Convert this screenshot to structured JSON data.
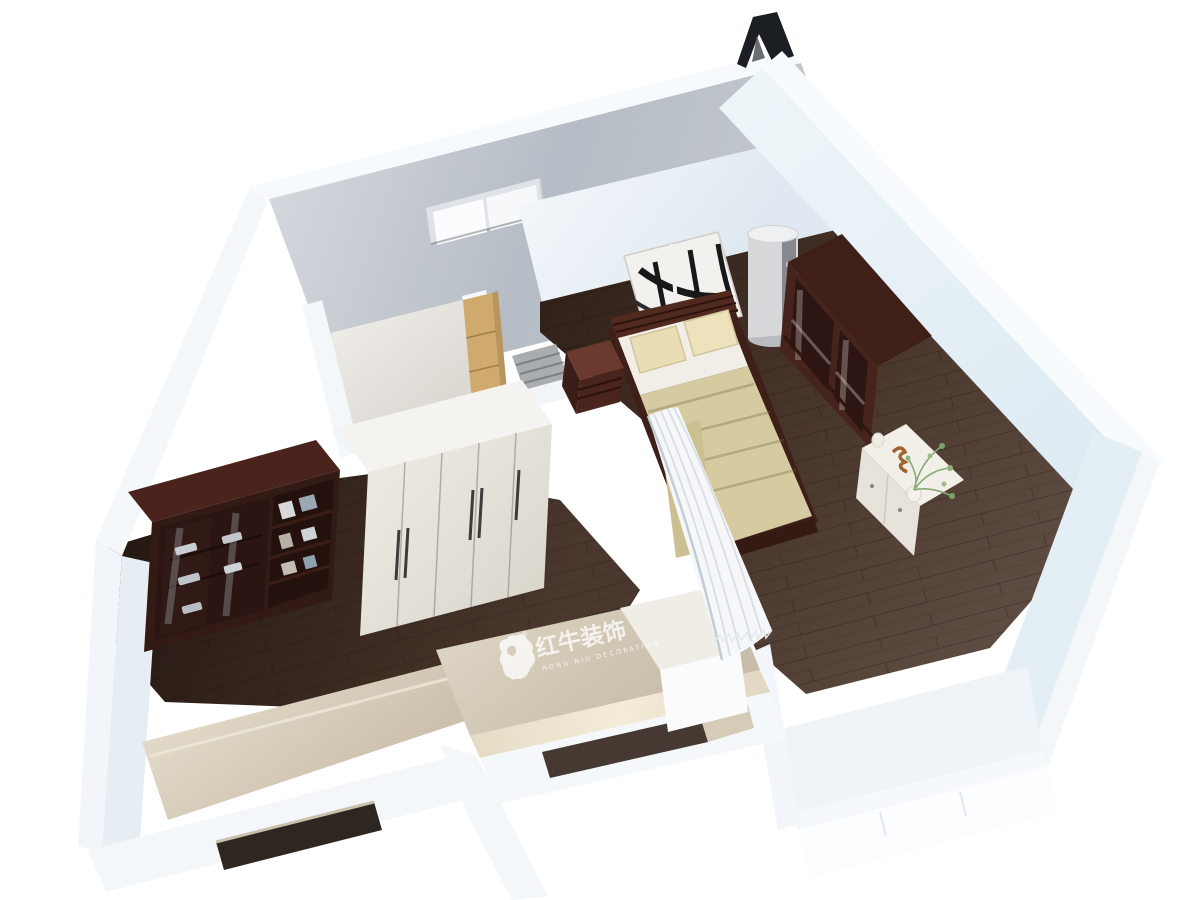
{
  "scene": {
    "type": "3d-floorplan-render",
    "description": "Bird's-eye 3D dollhouse render of a small apartment: bedroom with dark-wood floor and mahogany furniture, study room with bookcase and white wardrobe, entry hall, two bay/balcony niches, white walls on a white background",
    "background_color": "#ffffff"
  },
  "watermark": {
    "logo_icon": "bull-logo",
    "registered_mark": "®",
    "title": "红牛装饰",
    "subtitle": "HONG NIU DECORATION",
    "color": "#ffffff"
  },
  "palette": {
    "wall_white": "#f5f9fc",
    "wall_face_light": "#e9f1f7",
    "wall_face_shadow": "#dce7f0",
    "exterior_wall_gray": "#bcc2ca",
    "floor_dark_wood": "#362519",
    "floor_mid_wood": "#4e3b31",
    "floor_light_wood": "#5f4e44",
    "mahogany_dark": "#3f2019",
    "mahogany_mid": "#5a2d24",
    "bedding_sheet_white": "#f0eee6",
    "blanket_beige": "#d6caa0",
    "pillow_beige": "#e9ddb6",
    "curtain_white": "#f5f7f9",
    "balcony_beige": "#d9d0bf",
    "glow_warm": "#f0e7d3",
    "closet_wood_tan": "#d0a96e",
    "ac_body_gray": "#d6d8d9",
    "ac_slot_dark": "#85898c",
    "white_furniture": "#e9e6de",
    "plant_green": "#7da468",
    "ornament_black": "#1b1e23",
    "window_slot_dark": "#3a2f28"
  },
  "architecture": {
    "rear_window": {
      "name": "rear-wall-window",
      "panes": 2
    },
    "entry_door": {
      "name": "entry-door-opening",
      "state": "open"
    },
    "left_bay_window_slot": {
      "name": "left-bay-window-slot"
    },
    "front_bay_window_slot": {
      "name": "front-bay-window-slot"
    },
    "roof_ornament": {
      "name": "black-roof-ornament",
      "shape": "inverted-V"
    }
  },
  "rooms": [
    {
      "name": "bedroom",
      "floor": "dark wood planks"
    },
    {
      "name": "entry-hall",
      "floor": "dark wood planks"
    },
    {
      "name": "study-room",
      "floor": "dark wood planks"
    },
    {
      "name": "small-room",
      "floor": "pale screed"
    },
    {
      "name": "left-balcony-bay",
      "floor": "beige counter"
    },
    {
      "name": "front-balcony-bay",
      "floor": "beige wall with brand watermark"
    }
  ],
  "furniture": [
    {
      "name": "double-bed",
      "parts": [
        "slatted-headboard",
        "white-sheet",
        "two-beige-pillows",
        "beige-blanket",
        "dark-footboard"
      ]
    },
    {
      "name": "nightstand",
      "material": "dark mahogany"
    },
    {
      "name": "abstract-wall-art",
      "style": "black curves on white canvas"
    },
    {
      "name": "column-air-conditioner",
      "shape": "tall cylinder"
    },
    {
      "name": "glass-door-wardrobe",
      "material": "dark mahogany"
    },
    {
      "name": "white-dresser",
      "decor": [
        "green-plant",
        "vase",
        "squiggle-ornament"
      ]
    },
    {
      "name": "bookcase",
      "parts": [
        "glass-doors",
        "open-shelves",
        "books-and-dishes"
      ]
    },
    {
      "name": "white-wardrobe",
      "doors": 5,
      "handles": "dark vertical bars"
    },
    {
      "name": "pleated-curtain-divider",
      "color": "white"
    },
    {
      "name": "tan-closet-unit",
      "material": "light wood"
    },
    {
      "name": "striped-doormat",
      "color": "gray"
    },
    {
      "name": "white-low-cabinet"
    }
  ]
}
